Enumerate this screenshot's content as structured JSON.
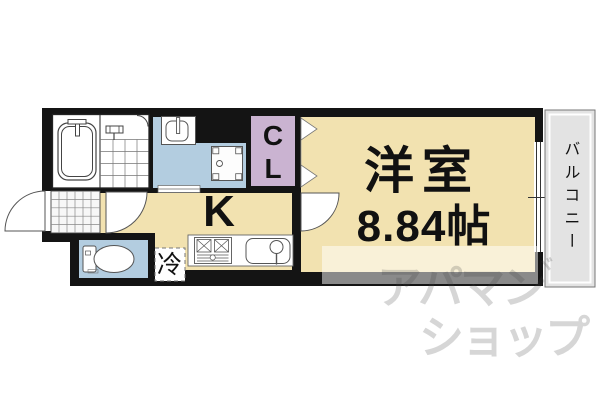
{
  "floorplan": {
    "labels": {
      "main_room_name": "洋室",
      "main_room_size": "8.84帖",
      "kitchen": "K",
      "closet": [
        "C",
        "L"
      ],
      "refrigerator": "冷",
      "balcony": "バルコニー"
    },
    "watermark": {
      "line1": "アパマン",
      "line2": "ショップ",
      "mark": "ヾ"
    },
    "colors": {
      "wall": "#141414",
      "room_floor": "#f2e2b0",
      "wet_area": "#b3cde0",
      "closet": "#cab3d1",
      "balcony": "#e3e3e3",
      "fixture_white": "#ffffff",
      "tile": "#f7f7f7"
    }
  }
}
